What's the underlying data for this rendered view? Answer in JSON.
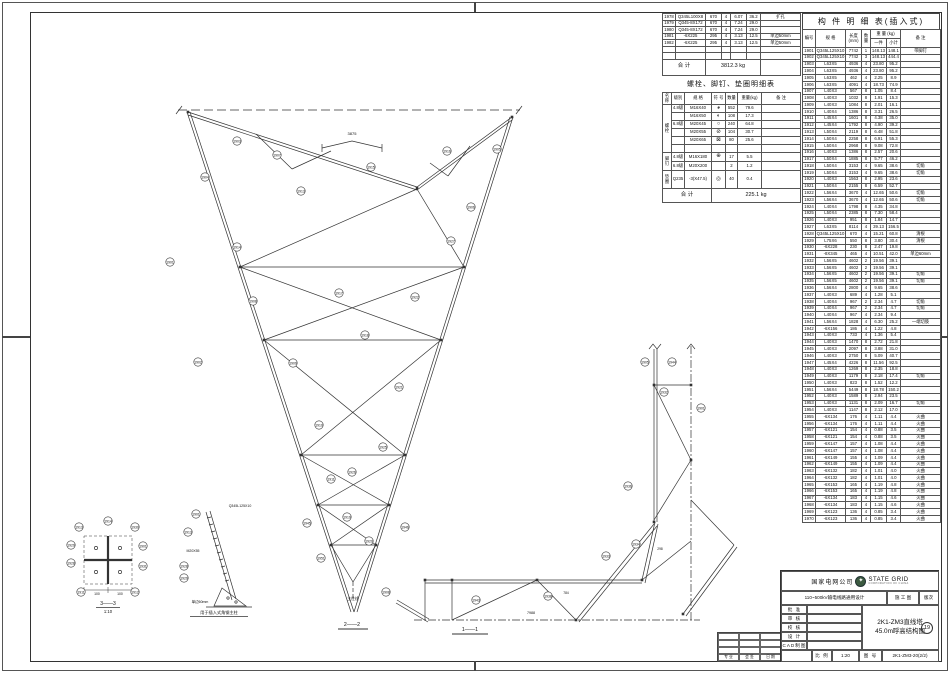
{
  "member_table": {
    "title": "构 件 明 细 表(插入式)",
    "headers": {
      "no": "编号",
      "spec": "规 格",
      "len": "长度\n(mm)",
      "qty": "数\n量",
      "weight": "重 量 (kg)",
      "one": "一件",
      "sub": "小计",
      "note": "备 注"
    },
    "rows": [
      [
        "1901",
        "Q345L125X10",
        "7742",
        "1",
        "148.13",
        "148.1",
        "带脚钉"
      ],
      [
        "1902",
        "Q345L125X10",
        "7742",
        "3",
        "148.13",
        "444.4",
        ""
      ],
      [
        "1903",
        "L63X5",
        "4936",
        "4",
        "23.80",
        "95.2",
        ""
      ],
      [
        "1904",
        "L63X5",
        "4936",
        "4",
        "23.80",
        "95.2",
        ""
      ],
      [
        "1905",
        "L63X5",
        "462",
        "4",
        "2.25",
        "8.9",
        ""
      ],
      [
        "1906",
        "L63X5",
        "4091",
        "4",
        "18.73",
        "74.9",
        ""
      ],
      [
        "1907",
        "L40X3",
        "567",
        "8",
        "1.05",
        "8.4",
        ""
      ],
      [
        "1908",
        "L40X3",
        "1032",
        "8",
        "1.91",
        "15.3",
        ""
      ],
      [
        "1909",
        "L40X3",
        "1084",
        "8",
        "2.01",
        "16.1",
        ""
      ],
      [
        "1910",
        "L40X4",
        "1386",
        "8",
        "3.31",
        "26.5",
        ""
      ],
      [
        "1911",
        "L45X4",
        "1601",
        "8",
        "4.38",
        "35.0",
        ""
      ],
      [
        "1912",
        "L45X4",
        "1792",
        "8",
        "4.90",
        "39.2",
        ""
      ],
      [
        "1913",
        "L50X4",
        "2119",
        "8",
        "6.48",
        "51.8",
        ""
      ],
      [
        "1914",
        "L50X4",
        "2258",
        "8",
        "6.91",
        "55.3",
        ""
      ],
      [
        "1915",
        "L50X4",
        "2968",
        "8",
        "9.08",
        "72.8",
        ""
      ],
      [
        "1916",
        "L40X3",
        "1386",
        "8",
        "2.57",
        "20.6",
        ""
      ],
      [
        "1917",
        "L50X4",
        "1885",
        "8",
        "5.77",
        "46.2",
        ""
      ],
      [
        "1918",
        "L50X4",
        "3153",
        "4",
        "9.65",
        "38.6",
        "切角"
      ],
      [
        "1919",
        "L50X4",
        "3153",
        "4",
        "9.65",
        "38.6",
        "切角"
      ],
      [
        "1920",
        "L40X3",
        "1563",
        "8",
        "2.95",
        "23.6",
        ""
      ],
      [
        "1921",
        "L50X4",
        "2155",
        "8",
        "6.59",
        "52.7",
        ""
      ],
      [
        "1922",
        "L56X4",
        "3670",
        "4",
        "12.65",
        "50.6",
        "切角"
      ],
      [
        "1923",
        "L56X4",
        "3670",
        "4",
        "12.65",
        "50.6",
        "切角"
      ],
      [
        "1924",
        "L40X4",
        "1798",
        "8",
        "4.35",
        "34.8",
        ""
      ],
      [
        "1925",
        "L50X4",
        "2385",
        "8",
        "7.30",
        "58.4",
        ""
      ],
      [
        "1926",
        "L40X3",
        "951",
        "8",
        "1.84",
        "14.7",
        ""
      ],
      [
        "1927",
        "L63X5",
        "8114",
        "4",
        "39.13",
        "156.5",
        ""
      ],
      [
        "1928",
        "Q345L125X10",
        "670",
        "4",
        "15.21",
        "60.8",
        "清根"
      ],
      [
        "1929",
        "L75X6",
        "550",
        "8",
        "3.80",
        "30.4",
        "清根"
      ],
      [
        "1930",
        "-6X228",
        "230",
        "8",
        "2.47",
        "19.8",
        ""
      ],
      [
        "1931",
        "-8X345",
        "465",
        "4",
        "10.51",
        "42.0",
        "单边60mm"
      ],
      [
        "1932",
        "L56X5",
        "4602",
        "2",
        "19.56",
        "39.1",
        ""
      ],
      [
        "1933",
        "L56X5",
        "4602",
        "2",
        "19.56",
        "39.1",
        ""
      ],
      [
        "1934",
        "L56X5",
        "4602",
        "2",
        "19.56",
        "39.1",
        "切角"
      ],
      [
        "1935",
        "L56X5",
        "4602",
        "2",
        "19.56",
        "39.1",
        "切角"
      ],
      [
        "1936",
        "L56X4",
        "2800",
        "4",
        "9.65",
        "38.6",
        ""
      ],
      [
        "1937",
        "L40X3",
        "689",
        "4",
        "1.28",
        "5.1",
        ""
      ],
      [
        "1938",
        "L40X4",
        "967",
        "2",
        "2.34",
        "4.7",
        "切角"
      ],
      [
        "1939",
        "L40X4",
        "967",
        "2",
        "2.34",
        "4.7",
        "切角"
      ],
      [
        "1940",
        "L40X4",
        "967",
        "4",
        "2.34",
        "9.4",
        ""
      ],
      [
        "1941",
        "L56X4",
        "1828",
        "4",
        "6.30",
        "25.2",
        "一端切肢"
      ],
      [
        "1942",
        "-6X156",
        "186",
        "4",
        "1.22",
        "4.8",
        ""
      ],
      [
        "1943",
        "L40X3",
        "733",
        "4",
        "1.36",
        "5.4",
        ""
      ],
      [
        "1944",
        "L40X3",
        "1470",
        "8",
        "2.72",
        "21.8",
        ""
      ],
      [
        "1945",
        "L40X3",
        "2097",
        "8",
        "3.88",
        "31.0",
        ""
      ],
      [
        "1946",
        "L40X3",
        "2750",
        "8",
        "5.09",
        "40.7",
        ""
      ],
      [
        "1947",
        "L45X4",
        "4226",
        "8",
        "11.56",
        "92.5",
        ""
      ],
      [
        "1948",
        "L40X3",
        "1269",
        "8",
        "2.35",
        "18.8",
        ""
      ],
      [
        "1949",
        "L40X3",
        "1179",
        "8",
        "2.18",
        "17.4",
        "切角"
      ],
      [
        "1950",
        "L40X3",
        "823",
        "8",
        "1.52",
        "12.2",
        ""
      ],
      [
        "1951",
        "L56X4",
        "5449",
        "8",
        "18.78",
        "150.2",
        ""
      ],
      [
        "1952",
        "L40X3",
        "1589",
        "8",
        "2.94",
        "23.5",
        ""
      ],
      [
        "1953",
        "L40X3",
        "1131",
        "8",
        "2.09",
        "16.7",
        "切角"
      ],
      [
        "1954",
        "L40X3",
        "1147",
        "8",
        "2.12",
        "17.0",
        ""
      ],
      [
        "1955",
        "-6X134",
        "176",
        "4",
        "1.11",
        "4.4",
        "火曲"
      ],
      [
        "1956",
        "-6X134",
        "176",
        "4",
        "1.11",
        "4.4",
        "火曲"
      ],
      [
        "1957",
        "-6X121",
        "154",
        "4",
        "0.88",
        "3.5",
        "火曲"
      ],
      [
        "1958",
        "-6X121",
        "154",
        "4",
        "0.88",
        "3.5",
        "火曲"
      ],
      [
        "1959",
        "-6X147",
        "157",
        "4",
        "1.08",
        "4.4",
        "火曲"
      ],
      [
        "1960",
        "-6X147",
        "157",
        "4",
        "1.08",
        "4.4",
        "火曲"
      ],
      [
        "1961",
        "-6X149",
        "155",
        "4",
        "1.09",
        "4.4",
        "火曲"
      ],
      [
        "1962",
        "-6X149",
        "155",
        "4",
        "1.09",
        "4.4",
        "火曲"
      ],
      [
        "1963",
        "-6X132",
        "182",
        "4",
        "1.01",
        "4.0",
        "火曲"
      ],
      [
        "1964",
        "-6X132",
        "182",
        "4",
        "1.01",
        "4.0",
        "火曲"
      ],
      [
        "1965",
        "-6X153",
        "165",
        "4",
        "1.19",
        "4.8",
        "火曲"
      ],
      [
        "1966",
        "-6X153",
        "165",
        "4",
        "1.19",
        "4.8",
        "火曲"
      ],
      [
        "1967",
        "-6X134",
        "183",
        "4",
        "1.15",
        "4.6",
        "火曲"
      ],
      [
        "1968",
        "-6X134",
        "183",
        "4",
        "1.15",
        "4.6",
        "火曲"
      ],
      [
        "1969",
        "-6X123",
        "136",
        "4",
        "0.85",
        "3.4",
        "火曲"
      ],
      [
        "1970",
        "-6X123",
        "136",
        "4",
        "0.85",
        "3.4",
        "火曲"
      ]
    ]
  },
  "cont_table": {
    "rows": [
      [
        "1978",
        "Q345L100X8",
        "670",
        "4",
        "6.07",
        "36.2",
        "扩孔"
      ],
      [
        "1979",
        "Q345-8X172",
        "670",
        "4",
        "7.24",
        "29.0",
        ""
      ],
      [
        "1980",
        "Q345-8X172",
        "670",
        "4",
        "7.24",
        "29.0",
        ""
      ],
      [
        "1981",
        "-6X225",
        "295",
        "4",
        "3.13",
        "12.5",
        "单边50mm"
      ],
      [
        "1982",
        "-6X225",
        "295",
        "4",
        "3.13",
        "12.5",
        "单边50mm"
      ]
    ],
    "empty_rows": 2,
    "total_label": "合  计",
    "total_value": "3812.3 kg"
  },
  "bolt_table": {
    "title": "螺栓、脚钉、垫圈明细表",
    "headers": [
      "名称",
      "级别",
      "规 格",
      "符 号",
      "数量",
      "重量(kg)",
      "备 注"
    ],
    "groups": [
      {
        "name": "螺\n栓",
        "rows": [
          {
            "grade": "4.8级",
            "spec": "M16X40",
            "sym": "◕",
            "qty": "552",
            "wt": "79.6"
          },
          {
            "grade": "",
            "spec": "M16X50",
            "sym": "◐",
            "qty": "108",
            "wt": "17.3"
          },
          {
            "grade": "6.8级",
            "spec": "M20X45",
            "sym": "○",
            "qty": "240",
            "wt": "64.8"
          },
          {
            "grade": "",
            "spec": "M20X55",
            "sym": "⊘",
            "qty": "104",
            "wt": "30.7"
          },
          {
            "grade": "",
            "spec": "M20X65",
            "sym": "⊠",
            "qty": "80",
            "wt": "25.6"
          },
          {
            "grade": "",
            "spec": "",
            "sym": "",
            "qty": "",
            "wt": ""
          }
        ]
      },
      {
        "name": "脚\n钉",
        "rows": [
          {
            "grade": "4.8级",
            "spec": "M16X180",
            "sym": "⊕",
            "qty": "17",
            "wt": "5.5"
          },
          {
            "grade": "6.8级",
            "spec": "M20X200",
            "sym": "",
            "qty": "2",
            "wt": "1.2"
          }
        ]
      },
      {
        "name": "垫\n圈",
        "rows": [
          {
            "grade": "Q235",
            "spec": "-3(X47.5)",
            "sym": "◎",
            "qty": "40",
            "wt": "0.4"
          }
        ]
      }
    ],
    "total_label": "合  计",
    "total_value": "225.1 kg"
  },
  "title_block": {
    "company": "国家电网公司",
    "brand": "STATE GRID",
    "brand_sub": "CORPORATION OF CHINA",
    "project": "110~500kV输电线路通用设计",
    "stage": "施 工 图",
    "revision": "版次",
    "approval_rows": [
      "批 准",
      "审 核",
      "校 核",
      "设 计",
      "CAD制图"
    ],
    "title_line1": "2K1-ZM3直线塔",
    "title_line2": "45.0m呼高结构图",
    "sheet_badge": "19",
    "scale_label": "比 例",
    "scale_value": "1:20",
    "number_label": "图 号",
    "drawing_number": "2K1-ZM3-20(2/2)",
    "sig_labels": [
      "专 业",
      "会 签",
      "日 期"
    ]
  },
  "drawing": {
    "captions": {
      "main_section": "2——2",
      "plan_section": "1——1",
      "detail_section": "3——3",
      "detail_scale": "1:10",
      "axis_label": "主柱线",
      "detail_b_caption": "用于插入式角钢主柱"
    },
    "labels": [
      {
        "t": "3875",
        "x": 352,
        "y": 135,
        "s": 4
      },
      {
        "t": "7988",
        "x": 531,
        "y": 614,
        "s": 3.6
      },
      {
        "t": "784",
        "x": 566,
        "y": 594,
        "s": 3.3
      },
      {
        "t": "298",
        "x": 660,
        "y": 550,
        "s": 3.3
      },
      {
        "t": "Q345L125X10",
        "x": 240,
        "y": 507,
        "s": 3.5
      },
      {
        "t": "M20X55",
        "x": 193,
        "y": 552,
        "s": 3.5
      },
      {
        "t": "单边60mm",
        "x": 200,
        "y": 603,
        "s": 3.5
      },
      {
        "t": "100",
        "x": 97,
        "y": 595,
        "s": 3.4
      },
      {
        "t": "100",
        "x": 120,
        "y": 595,
        "s": 3.4
      }
    ],
    "callouts_main": [
      [
        1903,
        237,
        141
      ],
      [
        1907,
        277,
        155
      ],
      [
        1915,
        371,
        167
      ],
      [
        1904,
        205,
        177
      ],
      [
        1913,
        301,
        191
      ],
      [
        1916,
        447,
        151
      ],
      [
        1905,
        497,
        149
      ],
      [
        1906,
        471,
        207
      ],
      [
        1927,
        451,
        241
      ],
      [
        1914,
        237,
        247
      ],
      [
        1901,
        170,
        262
      ],
      [
        1908,
        253,
        301
      ],
      [
        1917,
        339,
        293
      ],
      [
        1922,
        415,
        297
      ],
      [
        1909,
        293,
        363
      ],
      [
        1918,
        365,
        335
      ],
      [
        1902,
        198,
        362
      ],
      [
        1921,
        399,
        387
      ],
      [
        1910,
        319,
        425
      ],
      [
        1911,
        331,
        479
      ],
      [
        1925,
        383,
        447
      ],
      [
        1926,
        352,
        472
      ],
      [
        1919,
        347,
        517
      ],
      [
        1920,
        369,
        541
      ],
      [
        1945,
        307,
        523
      ],
      [
        1946,
        405,
        527
      ],
      [
        1951,
        321,
        558
      ]
    ],
    "callouts_plan": [
      [
        1908,
        386,
        592
      ],
      [
        1943,
        476,
        600
      ],
      [
        1938,
        548,
        596
      ],
      [
        1933,
        606,
        556
      ],
      [
        1934,
        636,
        544
      ],
      [
        1905,
        645,
        362
      ],
      [
        1944,
        672,
        362
      ],
      [
        1932,
        664,
        392
      ],
      [
        1901,
        701,
        408
      ],
      [
        1936,
        628,
        486
      ]
    ],
    "callouts_d33": [
      [
        1913,
        79,
        527
      ],
      [
        1914,
        108,
        521
      ],
      [
        1930,
        135,
        527
      ],
      [
        1929,
        71,
        545
      ],
      [
        1928,
        71,
        563
      ],
      [
        1901,
        143,
        546
      ],
      [
        1931,
        143,
        566
      ],
      [
        1911,
        81,
        592
      ],
      [
        1912,
        135,
        592
      ]
    ],
    "callouts_db": [
      [
        1901,
        196,
        514
      ],
      [
        1913,
        188,
        532
      ],
      [
        1928,
        184,
        566
      ],
      [
        1929,
        184,
        578
      ]
    ]
  }
}
